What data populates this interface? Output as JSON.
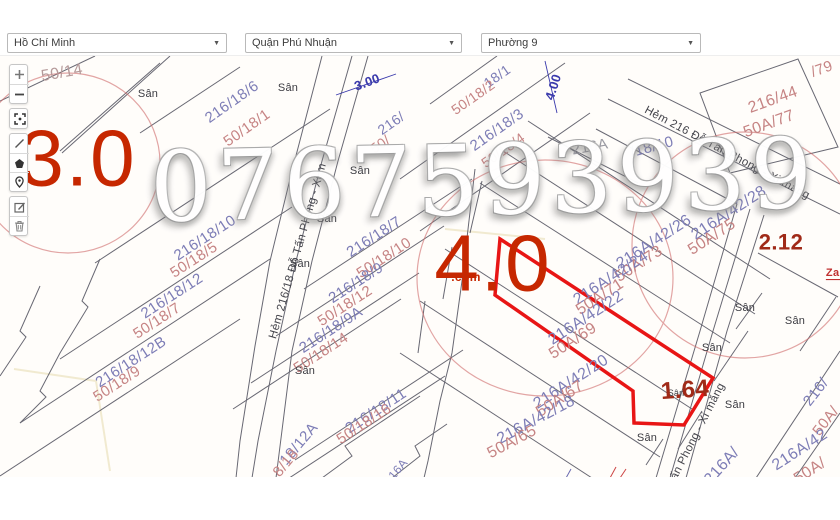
{
  "header": {
    "city": "Hồ Chí Minh",
    "district": "Quận Phú Nhuận",
    "ward": "Phường 9",
    "caret": "▼"
  },
  "toolbar": {
    "buttons": [
      "zoom-in",
      "zoom-out",
      "fullscreen",
      "measure-line",
      "draw-polygon",
      "marker",
      "edit",
      "delete"
    ]
  },
  "map": {
    "watermark": "0767593939",
    "annotation_colors": {
      "highlight": "#e81515",
      "circle": "#cf6a6a",
      "big_red": "#c62700"
    },
    "labels": [
      {
        "t": "50/14",
        "x": 62,
        "y": 72,
        "r": -10,
        "c": "faded",
        "s": 16,
        "n": "parcel-label"
      },
      {
        "t": "216/18/6",
        "x": 232,
        "y": 101,
        "r": -35,
        "c": "new",
        "s": 15,
        "n": "parcel-label"
      },
      {
        "t": "50/18/1",
        "x": 247,
        "y": 127,
        "r": -35,
        "c": "old",
        "s": 15,
        "n": "parcel-label"
      },
      {
        "t": "18/1",
        "x": 497,
        "y": 75,
        "r": -35,
        "c": "new",
        "s": 14,
        "n": "parcel-label"
      },
      {
        "t": "50/18/2",
        "x": 473,
        "y": 96,
        "r": -35,
        "c": "old",
        "s": 14,
        "n": "parcel-label"
      },
      {
        "t": "216/18/3",
        "x": 497,
        "y": 129,
        "r": -35,
        "c": "new",
        "s": 15,
        "n": "parcel-label"
      },
      {
        "t": "50/18/4",
        "x": 503,
        "y": 149,
        "r": -35,
        "c": "old",
        "s": 14,
        "n": "parcel-label"
      },
      {
        "t": "216/",
        "x": 391,
        "y": 122,
        "r": -35,
        "c": "new",
        "s": 14,
        "n": "parcel-label"
      },
      {
        "t": "50/",
        "x": 380,
        "y": 143,
        "r": -35,
        "c": "old",
        "s": 14,
        "n": "parcel-label"
      },
      {
        "t": "216/18/10",
        "x": 205,
        "y": 237,
        "r": -33,
        "c": "new",
        "s": 15,
        "n": "parcel-label"
      },
      {
        "t": "50/18/5",
        "x": 194,
        "y": 259,
        "r": -33,
        "c": "old",
        "s": 15,
        "n": "parcel-label"
      },
      {
        "t": "216/18/12",
        "x": 172,
        "y": 295,
        "r": -33,
        "c": "new",
        "s": 15,
        "n": "parcel-label"
      },
      {
        "t": "50/18/7",
        "x": 157,
        "y": 320,
        "r": -33,
        "c": "old",
        "s": 15,
        "n": "parcel-label"
      },
      {
        "t": "216/18/12B",
        "x": 131,
        "y": 361,
        "r": -33,
        "c": "new",
        "s": 15,
        "n": "parcel-label"
      },
      {
        "t": "50/18/9",
        "x": 117,
        "y": 383,
        "r": -33,
        "c": "old",
        "s": 15,
        "n": "parcel-label"
      },
      {
        "t": "216/18/7",
        "x": 374,
        "y": 236,
        "r": -33,
        "c": "new",
        "s": 15,
        "n": "parcel-label"
      },
      {
        "t": "50/18/10",
        "x": 384,
        "y": 257,
        "r": -33,
        "c": "old",
        "s": 15,
        "n": "parcel-label"
      },
      {
        "t": "216/18/9",
        "x": 356,
        "y": 282,
        "r": -33,
        "c": "new",
        "s": 15,
        "n": "parcel-label"
      },
      {
        "t": "50/18/12",
        "x": 345,
        "y": 305,
        "r": -33,
        "c": "old",
        "s": 15,
        "n": "parcel-label"
      },
      {
        "t": "216/18/9A",
        "x": 331,
        "y": 329,
        "r": -33,
        "c": "new",
        "s": 15,
        "n": "parcel-label"
      },
      {
        "t": "50/18/14",
        "x": 321,
        "y": 352,
        "r": -33,
        "c": "old",
        "s": 15,
        "n": "parcel-label"
      },
      {
        "t": "216/18/11",
        "x": 376,
        "y": 410,
        "r": -33,
        "c": "new",
        "s": 15,
        "n": "parcel-label"
      },
      {
        "t": "50/18/16",
        "x": 364,
        "y": 423,
        "r": -33,
        "c": "old",
        "s": 15,
        "n": "parcel-label"
      },
      {
        "t": "18/12A",
        "x": 299,
        "y": 443,
        "r": -50,
        "c": "new",
        "s": 15,
        "n": "parcel-label"
      },
      {
        "t": "8/18",
        "x": 286,
        "y": 462,
        "r": -50,
        "c": "old",
        "s": 15,
        "n": "parcel-label"
      },
      {
        "t": "216A/42/28",
        "x": 729,
        "y": 212,
        "r": -33,
        "c": "new",
        "s": 16,
        "n": "parcel-label"
      },
      {
        "t": "50A/75",
        "x": 712,
        "y": 236,
        "r": -33,
        "c": "old",
        "s": 16,
        "n": "parcel-label"
      },
      {
        "t": "216A/42/26",
        "x": 654,
        "y": 241,
        "r": -33,
        "c": "new",
        "s": 16,
        "n": "parcel-label"
      },
      {
        "t": "50A/73",
        "x": 639,
        "y": 263,
        "r": -33,
        "c": "old",
        "s": 16,
        "n": "parcel-label"
      },
      {
        "t": "216A/42/24",
        "x": 611,
        "y": 277,
        "r": -33,
        "c": "new",
        "s": 16,
        "n": "parcel-label"
      },
      {
        "t": "50A/71",
        "x": 600,
        "y": 296,
        "r": -33,
        "c": "old",
        "s": 16,
        "n": "parcel-label"
      },
      {
        "t": "216A/42/22",
        "x": 586,
        "y": 317,
        "r": -33,
        "c": "new",
        "s": 16,
        "n": "parcel-label"
      },
      {
        "t": "50A/69",
        "x": 573,
        "y": 340,
        "r": -33,
        "c": "old",
        "s": 16,
        "n": "parcel-label"
      },
      {
        "t": "216A/42/20",
        "x": 571,
        "y": 381,
        "r": -33,
        "c": "new",
        "s": 16,
        "n": "parcel-label"
      },
      {
        "t": "50A/67",
        "x": 560,
        "y": 398,
        "r": -33,
        "c": "old",
        "s": 16,
        "n": "parcel-label"
      },
      {
        "t": "216A/42/18",
        "x": 536,
        "y": 419,
        "r": -28,
        "c": "new",
        "s": 16,
        "n": "parcel-label"
      },
      {
        "t": "50A/65",
        "x": 512,
        "y": 441,
        "r": -28,
        "c": "old",
        "s": 16,
        "n": "parcel-label"
      },
      {
        "t": "216/44",
        "x": 773,
        "y": 99,
        "r": -20,
        "c": "old",
        "s": 16,
        "n": "parcel-label"
      },
      {
        "t": "50A/77",
        "x": 769,
        "y": 123,
        "r": -20,
        "c": "old",
        "s": 16,
        "n": "parcel-label"
      },
      {
        "t": "/79",
        "x": 822,
        "y": 68,
        "r": -20,
        "c": "old",
        "s": 15,
        "n": "parcel-label"
      },
      {
        "t": "216A",
        "x": 590,
        "y": 146,
        "r": -10,
        "c": "gray",
        "s": 15,
        "n": "block-label"
      },
      {
        "t": "/18/10",
        "x": 652,
        "y": 146,
        "r": -15,
        "c": "new",
        "s": 15,
        "n": "parcel-label"
      },
      {
        "t": "216A/",
        "x": 722,
        "y": 465,
        "r": -48,
        "c": "new",
        "s": 16,
        "n": "parcel-label"
      },
      {
        "t": "216/",
        "x": 816,
        "y": 391,
        "r": -52,
        "c": "new",
        "s": 15,
        "n": "parcel-label"
      },
      {
        "t": "50A/",
        "x": 826,
        "y": 420,
        "r": -52,
        "c": "old",
        "s": 15,
        "n": "parcel-label"
      },
      {
        "t": "216A/42",
        "x": 800,
        "y": 449,
        "r": -33,
        "c": "new",
        "s": 16,
        "n": "parcel-label"
      },
      {
        "t": "50A/",
        "x": 810,
        "y": 470,
        "r": -33,
        "c": "old",
        "s": 16,
        "n": "parcel-label"
      },
      {
        "t": "16A",
        "x": 398,
        "y": 468,
        "r": -50,
        "c": "new",
        "s": 12,
        "n": "parcel-label"
      },
      {
        "t": "3.00",
        "x": 367,
        "y": 81,
        "r": -20,
        "c": "dim",
        "s": 13,
        "n": "dimension-label"
      },
      {
        "t": "4.00",
        "x": 553,
        "y": 86,
        "r": -72,
        "c": "dim",
        "s": 13,
        "n": "dimension-label"
      },
      {
        "t": "Hẻm 216/18 Đỗ Tấn Phong - Xi m",
        "x": 298,
        "y": 250,
        "r": -74,
        "c": "street",
        "s": 11.5,
        "n": "street-label"
      },
      {
        "t": "Hẻm 216 Đỗ Tấn Phong - Xi măng",
        "x": 727,
        "y": 152,
        "r": 28,
        "c": "street",
        "s": 11.5,
        "n": "street-label"
      },
      {
        "t": "Đỗ Tấn Phong - Xi măng",
        "x": 692,
        "y": 442,
        "r": -63,
        "c": "street",
        "s": 11.5,
        "n": "street-label"
      },
      {
        "t": "Sân",
        "x": 148,
        "y": 93,
        "r": 0,
        "c": "yard",
        "s": 11,
        "n": "yard-label"
      },
      {
        "t": "Sân",
        "x": 288,
        "y": 87,
        "r": 0,
        "c": "yard",
        "s": 11,
        "n": "yard-label"
      },
      {
        "t": "Sân",
        "x": 360,
        "y": 170,
        "r": 0,
        "c": "yard",
        "s": 11,
        "n": "yard-label"
      },
      {
        "t": "Sân",
        "x": 327,
        "y": 218,
        "r": 0,
        "c": "yard",
        "s": 11,
        "n": "yard-label"
      },
      {
        "t": "Sân",
        "x": 300,
        "y": 263,
        "r": 0,
        "c": "yard",
        "s": 11,
        "n": "yard-label"
      },
      {
        "t": "Sân",
        "x": 305,
        "y": 370,
        "r": 0,
        "c": "yard",
        "s": 11,
        "n": "yard-label"
      },
      {
        "t": "Sân",
        "x": 712,
        "y": 347,
        "r": 0,
        "c": "yard",
        "s": 11,
        "n": "yard-label"
      },
      {
        "t": "Sân",
        "x": 745,
        "y": 307,
        "r": 0,
        "c": "yard",
        "s": 11,
        "n": "yard-label"
      },
      {
        "t": "Sân",
        "x": 795,
        "y": 320,
        "r": 0,
        "c": "yard",
        "s": 11,
        "n": "yard-label"
      },
      {
        "t": "Sân",
        "x": 647,
        "y": 437,
        "r": 0,
        "c": "yard",
        "s": 11,
        "n": "yard-label"
      },
      {
        "t": "Sân",
        "x": 735,
        "y": 404,
        "r": 0,
        "c": "yard",
        "s": 11,
        "n": "yard-label"
      },
      {
        "t": "Sân",
        "x": 676,
        "y": 392,
        "r": 0,
        "c": "yard",
        "s": 9,
        "n": "yard-label"
      },
      {
        "t": "3.0",
        "x": 78,
        "y": 157,
        "r": 0,
        "c": "bigred",
        "s": 80,
        "n": "red-measure-label"
      },
      {
        "t": "4.0",
        "x": 493,
        "y": 262,
        "r": 0,
        "c": "bigred",
        "s": 80,
        "n": "red-measure-label"
      },
      {
        "t": ".com",
        "x": 466,
        "y": 276,
        "r": 0,
        "c": "bigred2",
        "s": 12,
        "n": "watermark-com"
      },
      {
        "t": "2.12",
        "x": 781,
        "y": 241,
        "r": 0,
        "c": "darkred",
        "s": 22,
        "n": "red-measure-label"
      },
      {
        "t": "1.64",
        "x": 685,
        "y": 389,
        "r": -4,
        "c": "darkred",
        "s": 24,
        "n": "red-measure-label"
      },
      {
        "t": "Zalo",
        "x": 838,
        "y": 272,
        "r": 0,
        "c": "contact",
        "s": 11,
        "n": "contact-fragment"
      }
    ]
  }
}
